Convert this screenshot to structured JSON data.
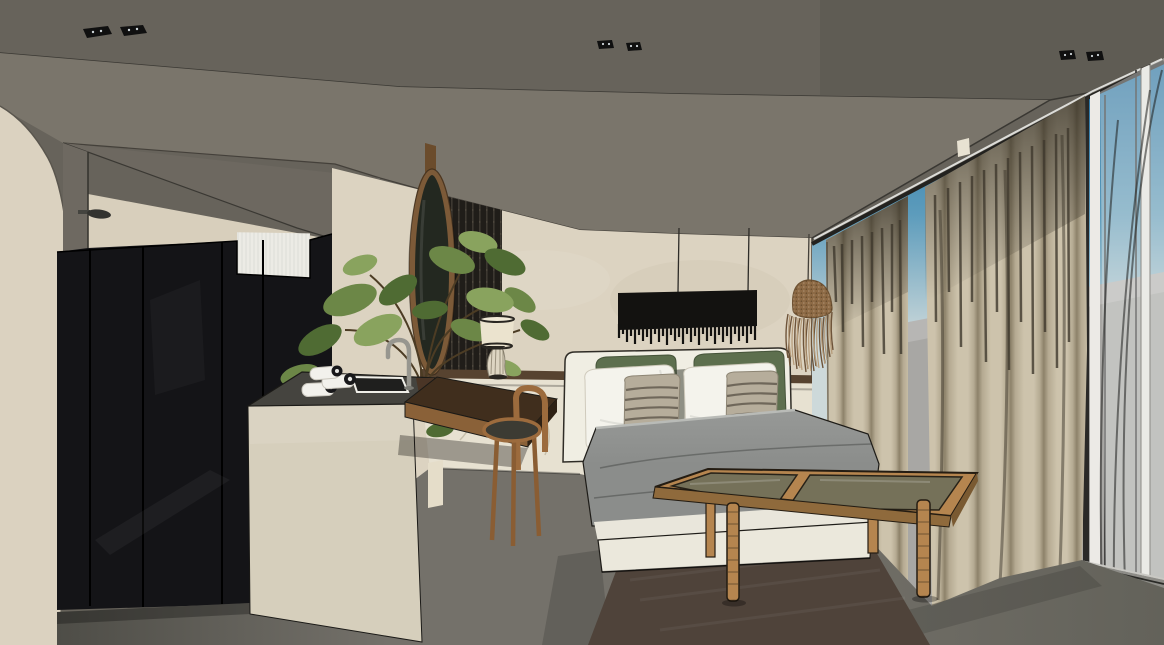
{
  "scene": {
    "type": "3d-interior-render",
    "subject": "hotel-suite-bedroom",
    "description": "SketchUp-style architectural rendering of a hotel bedroom suite with open vanity / bathroom area on the left, a double bed with fringe pendant lamp at center, linen curtains and floor-to-ceiling windows on the right",
    "camera": "one-point interior perspective",
    "time_of_day": "daytime (blue sky outside)"
  },
  "palette": {
    "ceiling": "#67635b",
    "ceilingShade": "#5e5a53",
    "soffit": "#7a756b",
    "bulkhead": "#6d6860",
    "edgeDark": "#3a3833",
    "outline": "#1b1a17",
    "wall": "#dcd3c1",
    "wallBand": "#d8cfbc",
    "arch": "#dbd2c0",
    "pillar": "#6e6961",
    "tile": "#ecebe5",
    "closet": "#141417",
    "rail": "#574330",
    "wainscot": "#e7e1d1",
    "slat": "#201d19",
    "slatRib": "#3d3831",
    "island": "#d6cfbc",
    "counter": "#45443f",
    "sinkDark": "#1f1f1e",
    "metal": "#97968f",
    "towel": "#f2f1ec",
    "towelCap": "#18181a",
    "mirrorFrame": "#7c5a38",
    "mirrorGlass": "#232820",
    "post": "#6b4c2c",
    "leafA": "#6c8747",
    "leafB": "#89a35e",
    "leafC": "#4f6b33",
    "stem": "#4c3c24",
    "pot": "#4a3526",
    "desk": "#402e1d",
    "deskEdge": "#8a6138",
    "deskEnd": "#2e2114",
    "stool": "#9c6b3d",
    "stoolSeat": "#3c3b33",
    "lampShade": "#ebe3ce",
    "lampBase": "#ddd5c2",
    "lampRim": "#2a2722",
    "headboard": "#f0eee3",
    "pillowWhite": "#f4f3ec",
    "pillowGreen": "#5d6f4e",
    "pillowStripeBase": "#b6ad9b",
    "pillowStripe": "#6f675a",
    "duvet": "#8b8d8b",
    "duvetLight": "#979997",
    "mattress": "#e9e6db",
    "bedBase": "#ebe8dc",
    "blackLamp": "#131210",
    "rattan": "#8d6a45",
    "rattanDark": "#6e5233",
    "strandLight": "#b59a78",
    "strandDark": "#6e543a",
    "curtain": "#cdc3ac",
    "curtainMid": "#b5aa92",
    "curtainDark": "#8d826a",
    "curtainDeep": "#3e382d",
    "skyTop": "#1a6ba0",
    "skyMid": "#5d9cbc",
    "skyLow": "#cdd9da",
    "outside": "#a8a7a4",
    "mullion": "#eceae6",
    "frameDark": "#23221f",
    "sheer": "#e8eae8",
    "floorA": "#4e4d47",
    "floorB": "#74716a",
    "floorC": "#63625a",
    "rug": "#4f433a",
    "tableWood": "#b5854f",
    "tableWoodDark": "#8f6a3c",
    "glass": "#70705a"
  },
  "objects": [
    {
      "name": "concrete-ceiling",
      "label": "dark concrete ceiling with sloped soffit"
    },
    {
      "name": "recessed-ceiling-lights",
      "label": "three pairs of recessed spotlights"
    },
    {
      "name": "arched-wall",
      "label": "plaster wall with arch at far left"
    },
    {
      "name": "shower-head",
      "label": "wall mounted rain shower head"
    },
    {
      "name": "glass-wardrobe",
      "label": "smoked glass wardrobe / shower partition"
    },
    {
      "name": "tiled-shower-wall",
      "label": "white tiled shower wall"
    },
    {
      "name": "vanity-island",
      "label": "stone vanity island with dark counter"
    },
    {
      "name": "towels",
      "label": "rolled white towels"
    },
    {
      "name": "sink-and-faucet",
      "label": "recessed basin with gooseneck faucet"
    },
    {
      "name": "oval-mirror",
      "label": "oval wood framed mirror on hanging post"
    },
    {
      "name": "plant",
      "label": "green indoor plant"
    },
    {
      "name": "slatted-panel",
      "label": "dark fluted wood panel"
    },
    {
      "name": "floating-desk",
      "label": "walnut floating console desk"
    },
    {
      "name": "stool",
      "label": "round wooden stool with curved back"
    },
    {
      "name": "table-lamp",
      "label": "drum shade table lamp with ribbed glass base"
    },
    {
      "name": "picture-rail",
      "label": "dark wood wainscot rail"
    },
    {
      "name": "marble-wainscot",
      "label": "light stone wainscot"
    },
    {
      "name": "bed",
      "label": "double bed with grey duvet"
    },
    {
      "name": "headboard",
      "label": "white upholstered headboard"
    },
    {
      "name": "pillows",
      "label": "white, olive green and striped pillows"
    },
    {
      "name": "black-fringe-pendant",
      "label": "wide black fringed pendant above bed"
    },
    {
      "name": "rattan-pendant",
      "label": "rattan fringe pendant near window"
    },
    {
      "name": "linen-curtains",
      "label": "two beige linen curtain panels"
    },
    {
      "name": "sheer-curtains",
      "label": "white sheer curtains"
    },
    {
      "name": "window-wall",
      "label": "floor-to-ceiling glazing with mullions"
    },
    {
      "name": "sky",
      "label": "blue gradient sky"
    },
    {
      "name": "terrace",
      "label": "grey exterior terrace"
    },
    {
      "name": "coffee-table",
      "label": "rattan bench coffee table with glass top"
    },
    {
      "name": "rug",
      "label": "dark brown area rug"
    },
    {
      "name": "concrete-floor",
      "label": "grey concrete floor"
    }
  ]
}
